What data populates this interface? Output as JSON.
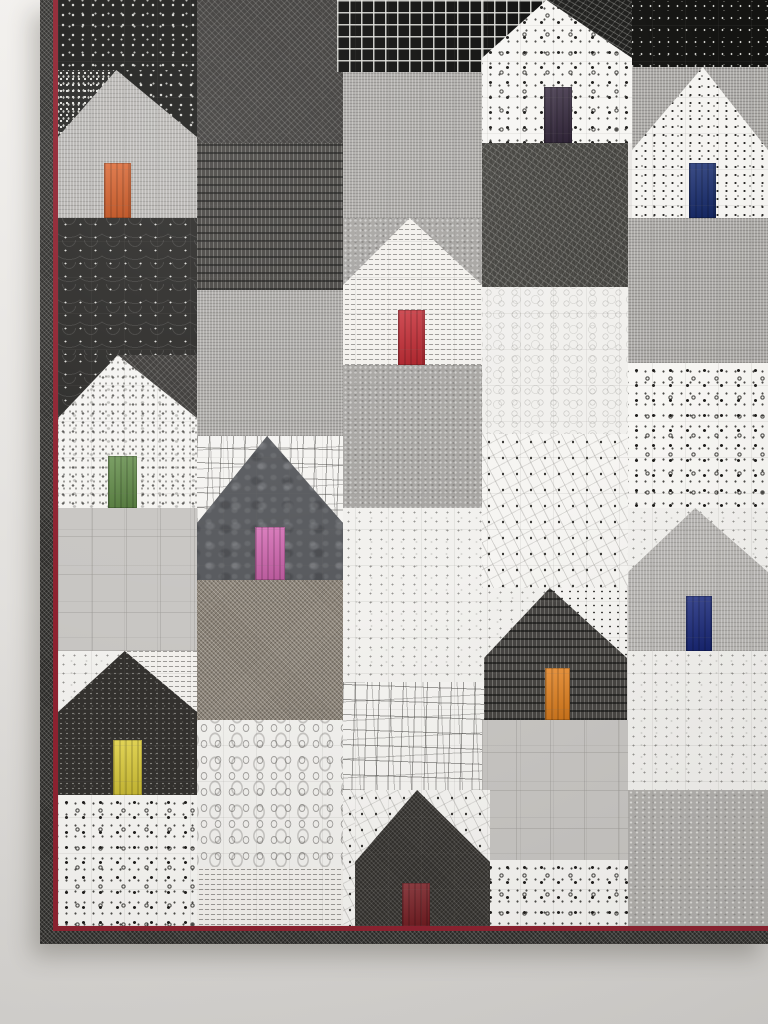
{
  "scene": {
    "subject": "Modern patchwork wall quilt of house blocks in black, white and gray prints, each house with a bright solid-color door, hanging on a pale wall",
    "wall": {
      "top_color": "#f2f0ed",
      "mid_color": "#e3e1de",
      "bottom_color": "#d6d4d1"
    }
  },
  "quilt": {
    "frame": {
      "left": 40,
      "top": 0,
      "width": 728,
      "height": 944
    },
    "binding": {
      "fabric": "binding",
      "label": "black diamond-texture binding with dark red flange",
      "accent_color": "#8e2230",
      "side_width": 13,
      "accent_width": 5,
      "bottom_top": 931,
      "bottom_height": 13,
      "accent_bottom_top": 926
    },
    "fabric_catalog": {
      "blackdot": "black with white dots",
      "dotstatic": "black with dense white speckle",
      "blackspeckle": "black with tiny white flecks",
      "windowpane": "black windowpane grid",
      "scallop": "black clamshell print",
      "darkcross": "charcoal diagonal crosshatch",
      "darkcols": "charcoal birch-stick print",
      "scribble": "dark scribble net",
      "scribbledark": "black scribble net",
      "graylinen": "gray linen weave",
      "grayweave": "gray crosshatch weave",
      "graymesh": "gray fan-stitch print",
      "grayplain": "plain pale gray",
      "graylace": "gray lace dot",
      "tweed": "taupe tweed fleck",
      "darkbatik": "slate batik leaf",
      "darkdotfine": "charcoal pin-dot",
      "darkfine": "black fine crosshatch",
      "whitesqdot": "white with black square dots",
      "whitedotfine": "white with fine black dots",
      "dotfade": "white with sparse dots",
      "whitetext": "white newsprint text",
      "whitesplat": "white paint-splatter",
      "whitespeckle": "white with gray speckle",
      "squares": "white with sketched rectangles",
      "swirl": "white swirl rings",
      "constellation": "white constellation dot-lines",
      "oval": "white oval rings"
    },
    "patches": [
      {
        "x": 18,
        "y": 0,
        "w": 139,
        "h": 70,
        "fabric": "blackdot"
      },
      {
        "x": 18,
        "y": 218,
        "w": 139,
        "h": 137,
        "fabric": "scallop"
      },
      {
        "x": 18,
        "y": 508,
        "w": 139,
        "h": 143,
        "fabric": "grayplain"
      },
      {
        "x": 18,
        "y": 795,
        "w": 139,
        "h": 135,
        "fabric": "whitesqdot"
      },
      {
        "x": 157,
        "y": 0,
        "w": 146,
        "h": 143,
        "fabric": "darkcross"
      },
      {
        "x": 157,
        "y": 143,
        "w": 146,
        "h": 147,
        "fabric": "darkcols"
      },
      {
        "x": 157,
        "y": 290,
        "w": 146,
        "h": 146,
        "fabric": "grayweave"
      },
      {
        "x": 157,
        "y": 580,
        "w": 146,
        "h": 140,
        "fabric": "tweed"
      },
      {
        "x": 157,
        "y": 720,
        "w": 146,
        "h": 147,
        "fabric": "oval"
      },
      {
        "x": 157,
        "y": 867,
        "w": 146,
        "h": 63,
        "fabric": "whitetext"
      },
      {
        "x": 297,
        "y": 0,
        "w": 145,
        "h": 72,
        "fabric": "windowpane"
      },
      {
        "x": 303,
        "y": 72,
        "w": 139,
        "h": 146,
        "fabric": "grayweave"
      },
      {
        "x": 303,
        "y": 365,
        "w": 144,
        "h": 143,
        "fabric": "graymesh"
      },
      {
        "x": 303,
        "y": 508,
        "w": 144,
        "h": 174,
        "fabric": "whitespeckle"
      },
      {
        "x": 303,
        "y": 682,
        "w": 144,
        "h": 108,
        "fabric": "squares"
      },
      {
        "x": 303,
        "y": 790,
        "w": 144,
        "h": 140,
        "fabric": "constellation"
      },
      {
        "x": 442,
        "y": 143,
        "w": 146,
        "h": 144,
        "fabric": "scribble"
      },
      {
        "x": 442,
        "y": 287,
        "w": 146,
        "h": 147,
        "fabric": "swirl"
      },
      {
        "x": 442,
        "y": 434,
        "w": 146,
        "h": 154,
        "fabric": "constellation"
      },
      {
        "x": 442,
        "y": 720,
        "w": 146,
        "h": 147,
        "fabric": "grayplain"
      },
      {
        "x": 442,
        "y": 860,
        "w": 146,
        "h": 70,
        "fabric": "whitesqdot"
      },
      {
        "x": 588,
        "y": 0,
        "w": 140,
        "h": 67,
        "fabric": "blackspeckle"
      },
      {
        "x": 588,
        "y": 218,
        "w": 140,
        "h": 145,
        "fabric": "grayweave"
      },
      {
        "x": 588,
        "y": 363,
        "w": 140,
        "h": 145,
        "fabric": "whitesqdot"
      },
      {
        "x": 588,
        "y": 651,
        "w": 140,
        "h": 139,
        "fabric": "whitespeckle"
      },
      {
        "x": 588,
        "y": 790,
        "w": 140,
        "h": 140,
        "fabric": "graylace"
      }
    ],
    "houses": [
      {
        "name": "house-gray-orange-door",
        "x": 18,
        "y": 70,
        "w": 139,
        "h": 148,
        "roof_h": 67,
        "peak_pct": 42,
        "fabric": "graylinen",
        "corner_left": "dotstatic",
        "corner_right": "blackdot",
        "door": {
          "x": 46,
          "y": 93,
          "w": 27,
          "h": 55,
          "color": "#d9581e"
        }
      },
      {
        "name": "house-dotted-purple-door",
        "x": 442,
        "y": 0,
        "w": 150,
        "h": 143,
        "roof_h": 58,
        "peak_pct": 43,
        "fabric": "whitesqdot",
        "corner_left": "windowpane",
        "corner_right": "scribbledark",
        "door": {
          "x": 62,
          "y": 87,
          "w": 28,
          "h": 56,
          "color": "#2e2137"
        }
      },
      {
        "name": "house-white-navy-door",
        "x": 592,
        "y": 67,
        "w": 136,
        "h": 151,
        "roof_h": 83,
        "peak_pct": 52,
        "fabric": "whitedotfine",
        "corner_left": "grayweave",
        "corner_right": "grayweave",
        "door": {
          "x": 57,
          "y": 96,
          "w": 27,
          "h": 55,
          "color": "#152a6e"
        }
      },
      {
        "name": "house-newsprint-red-door",
        "x": 303,
        "y": 218,
        "w": 139,
        "h": 147,
        "roof_h": 67,
        "peak_pct": 48,
        "fabric": "whitetext",
        "corner_left": "graymesh",
        "corner_right": "graymesh",
        "door": {
          "x": 55,
          "y": 92,
          "w": 27,
          "h": 55,
          "color": "#c4222b"
        }
      },
      {
        "name": "house-splatter-green-door",
        "x": 18,
        "y": 355,
        "w": 139,
        "h": 153,
        "roof_h": 63,
        "peak_pct": 43,
        "fabric": "whitesplat",
        "corner_left": "scallop",
        "corner_right": "darkcross",
        "door": {
          "x": 50,
          "y": 101,
          "w": 29,
          "h": 52,
          "color": "#5e8a43"
        }
      },
      {
        "name": "house-batik-pink-door",
        "x": 157,
        "y": 436,
        "w": 146,
        "h": 144,
        "roof_h": 87,
        "peak_pct": 48,
        "fabric": "darkbatik",
        "corner_left": "squares",
        "corner_right": "squares",
        "door": {
          "x": 58,
          "y": 91,
          "w": 30,
          "h": 53,
          "color": "#d465b2"
        }
      },
      {
        "name": "house-linen-blue-door",
        "x": 588,
        "y": 508,
        "w": 140,
        "h": 143,
        "roof_h": 64,
        "peak_pct": 48,
        "fabric": "graylinen",
        "corner_left": "whitespeckle",
        "corner_right": "whitespeckle",
        "door": {
          "x": 58,
          "y": 88,
          "w": 26,
          "h": 55,
          "color": "#17277d"
        }
      },
      {
        "name": "house-sticks-orange-door",
        "x": 444,
        "y": 588,
        "w": 143,
        "h": 132,
        "roof_h": 70,
        "peak_pct": 46,
        "fabric": "darkcols",
        "corner_left": "whitespeckle",
        "corner_right": "dotfade",
        "door": {
          "x": 61,
          "y": 80,
          "w": 25,
          "h": 52,
          "color": "#e8831d"
        }
      },
      {
        "name": "house-dark-yellow-door",
        "x": 18,
        "y": 651,
        "w": 139,
        "h": 144,
        "roof_h": 61,
        "peak_pct": 48,
        "fabric": "darkdotfine",
        "corner_left": "whitespeckle",
        "corner_right": "whitetext",
        "door": {
          "x": 55,
          "y": 89,
          "w": 29,
          "h": 55,
          "color": "#e2d138"
        }
      },
      {
        "name": "house-dark-maroon-door",
        "x": 315,
        "y": 790,
        "w": 135,
        "h": 140,
        "roof_h": 72,
        "peak_pct": 46,
        "fabric": "darkfine",
        "corner_left": "constellation",
        "corner_right": "constellation",
        "door": {
          "x": 47,
          "y": 93,
          "w": 28,
          "h": 47,
          "color": "#7a1a20"
        }
      }
    ]
  }
}
